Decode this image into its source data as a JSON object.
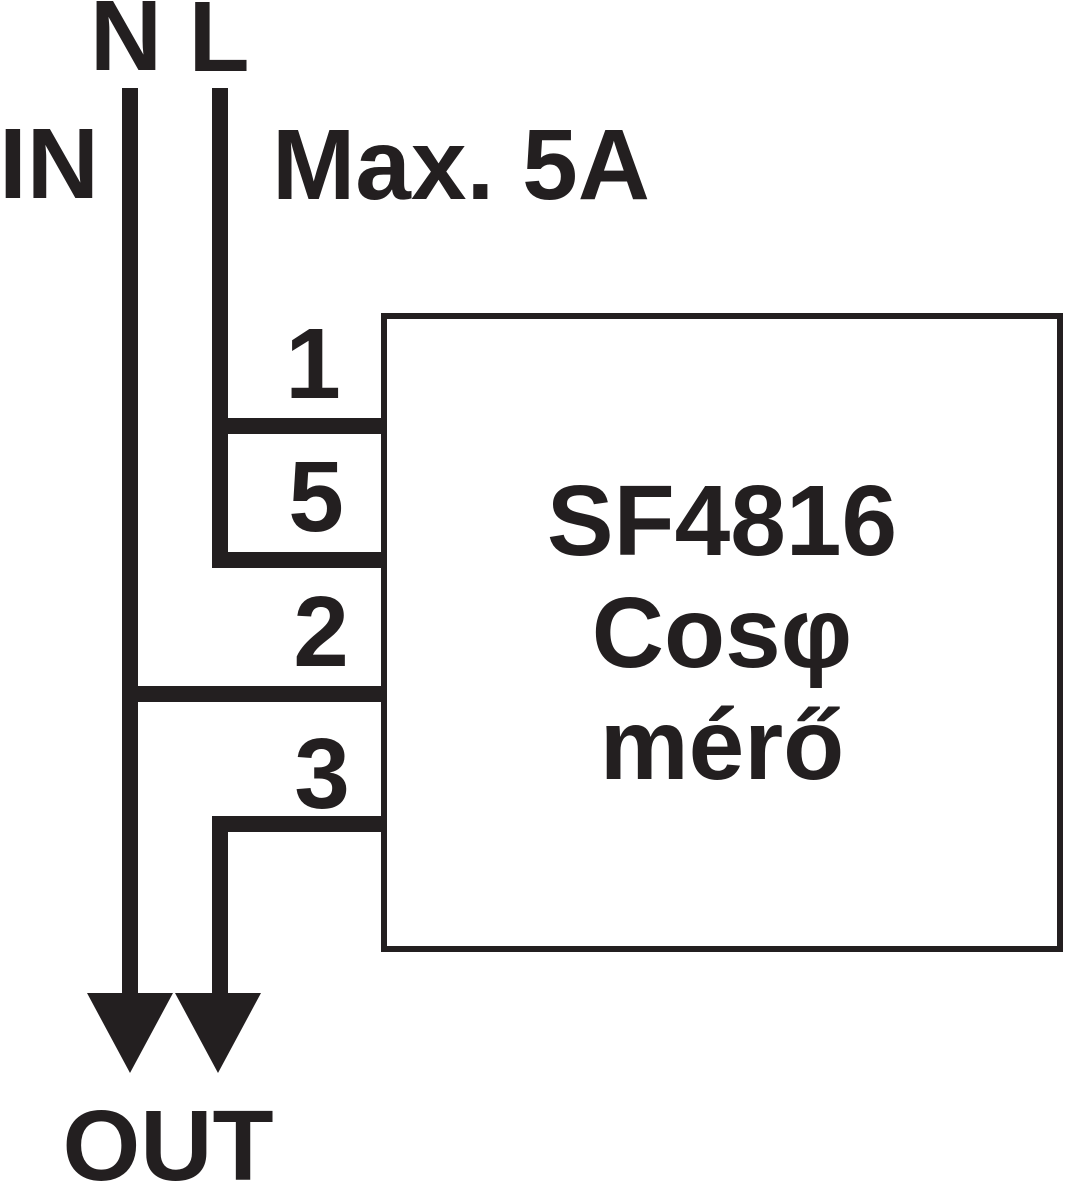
{
  "diagram": {
    "title": "SF4816 Cos-phi meter wiring diagram",
    "input_label": "IN",
    "output_label": "OUT",
    "rating_label": "Max. 5A",
    "wire_labels": {
      "neutral": "N",
      "line": "L"
    },
    "device": {
      "line1": "SF4816",
      "line2": "Cosφ",
      "line3": "mérő"
    },
    "terminals": [
      {
        "number": "1"
      },
      {
        "number": "5"
      },
      {
        "number": "2"
      },
      {
        "number": "3"
      }
    ]
  },
  "colors": {
    "ink": "#231f20",
    "background": "#ffffff"
  }
}
